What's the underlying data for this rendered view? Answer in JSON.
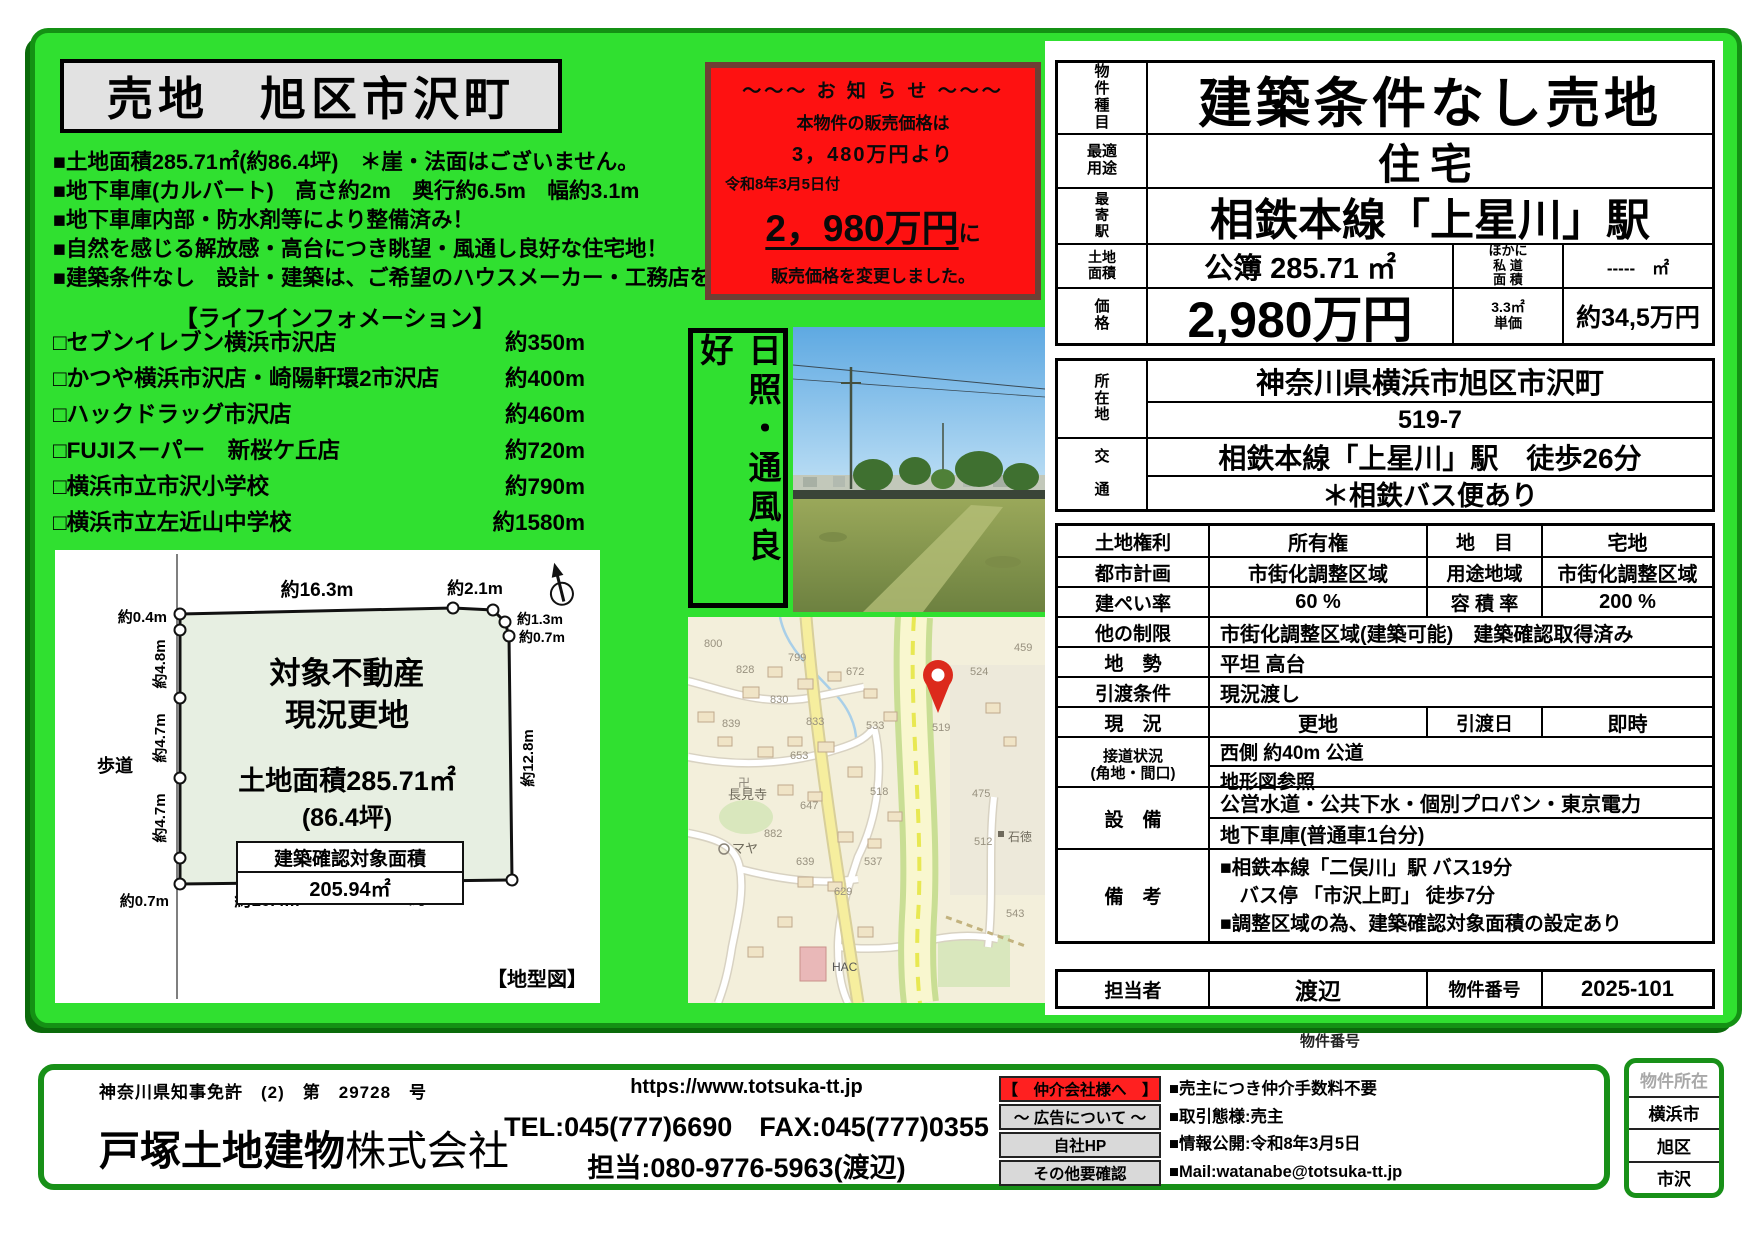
{
  "flyer": {
    "title": "売地　旭区市沢町",
    "bullets": [
      "■土地面積285.71㎡(約86.4坪)　＊崖・法面はございません。",
      "■地下車庫(カルバート)　高さ約2m　奥行約6.5m　幅約3.1m",
      "■地下車庫内部・防水剤等により整備済み！",
      "■自然を感じる解放感・高台につき眺望・風通し良好な住宅地！",
      "■建築条件なし　設計・建築は、ご希望のハウスメーカー・工務店を！"
    ],
    "life_title": "【ライフインフォメーション】",
    "life_items": [
      {
        "name": "□セブンイレブン横浜市沢店",
        "dist": "約350m"
      },
      {
        "name": "□かつや横浜市沢店・崎陽軒環2市沢店",
        "dist": "約400m"
      },
      {
        "name": "□ハックドラッグ市沢店",
        "dist": "約460m"
      },
      {
        "name": "□FUJIスーパー　新桜ケ丘店",
        "dist": "約720m"
      },
      {
        "name": "□横浜市立市沢小学校",
        "dist": "約790m"
      },
      {
        "name": "□横浜市立左近山中学校",
        "dist": "約1580m"
      }
    ]
  },
  "notice": {
    "header": "～～～ お 知 ら せ ～～～",
    "line1": "本物件の販売価格は",
    "line2": "3，480万円より",
    "date": "令和8年3月5日付",
    "new_price": "2，980万円",
    "new_price_suffix": "に",
    "line3": "販売価格を変更しました。"
  },
  "badge": {
    "text": "日照・通風良好"
  },
  "diagram": {
    "top1": "約16.3m",
    "top2": "約2.1m",
    "left1": "約0.4m",
    "left2": "約4.8m",
    "left3": "約4.7m",
    "left4": "約4.7m",
    "left5": "約0.7m",
    "right1": "約1.3m",
    "right2": "約0.7m",
    "right3": "約12.8m",
    "bottom1": "約10.4m",
    "bottom2": "約8.1m",
    "sidewalk": "歩道",
    "c1": "対象不動産",
    "c2": "現況更地",
    "c3": "土地面積285.71㎡",
    "c4": "(86.4坪)",
    "box_title": "建築確認対象面積",
    "box_value": "205.94㎡",
    "caption": "【地型図】"
  },
  "map": {
    "pin_label": "519",
    "temple_mark": "卍",
    "labels": [
      "800",
      "828",
      "799",
      "672",
      "830",
      "833",
      "839",
      "533",
      "653",
      "518",
      "647",
      "882",
      "639",
      "537",
      "629",
      "524",
      "459",
      "512",
      "543",
      "475",
      "石徳",
      "長見寺",
      "マヤ",
      "HAC"
    ]
  },
  "table": {
    "r1_label": "物\n件\n種\n目",
    "r1_value": "建築条件なし売地",
    "r2_label": "最適\n用途",
    "r2_value": "住宅",
    "r3_label": "最\n寄\n駅",
    "r3_value": "相鉄本線「上星川」駅",
    "r4_label": "土地\n面積",
    "r4_value": "公簿 285.71 ㎡",
    "r4_sublabel": "ほかに\n私 道\n面 積",
    "r4_subvalue": "-----　㎡",
    "r5_label": "価\n格",
    "r5_value": "2,980万円",
    "r5_sublabel": "3.3㎡\n単価",
    "r5_subvalue": "約34,5万円",
    "loc_label": "所\n在\n地",
    "loc1": "神奈川県横浜市旭区市沢町",
    "loc2": "519-7",
    "acc_label": "交\n\n通",
    "acc1": "相鉄本線「上星川」駅　徒歩26分",
    "acc2": "＊相鉄バス便あり",
    "rows3": [
      {
        "l": "土地権利",
        "v": "所有権",
        "l2": "地　目",
        "v2": "宅地"
      },
      {
        "l": "都市計画",
        "v": "市街化調整区域",
        "l2": "用途地域",
        "v2": "市街化調整区域"
      },
      {
        "l": "建ぺい率",
        "v": "60 %",
        "l2": "容 積 率",
        "v2": "200 %"
      },
      {
        "l": "他の制限",
        "v": "市街化調整区域(建築可能)　建築確認取得済み"
      },
      {
        "l": "地　勢",
        "v": "平坦 高台"
      },
      {
        "l": "引渡条件",
        "v": "現況渡し"
      },
      {
        "l": "現　況",
        "v": "更地",
        "l2": "引渡日",
        "v2": "即時"
      },
      {
        "l": "接道状況\n(角地・間口)",
        "v": "西側 約40m 公道",
        "v2": "地形図参照"
      },
      {
        "l": "設　備",
        "v": "公営水道・公共下水・個別プロパン・東京電力",
        "v2": "地下車庫(普通車1台分)"
      },
      {
        "l": "備　考",
        "v": "■相鉄本線「二俣川」駅 バス19分",
        "v2": "　バス停 「市沢上町」 徒歩7分",
        "v3": "■調整区域の為、建築確認対象面積の設定あり"
      }
    ],
    "staff_label": "担当者",
    "staff": "渡辺",
    "num_label": "物件番号",
    "num": "2025-101"
  },
  "footer": {
    "license": "神奈川県知事免許　(2)　第　29728　号",
    "company": "戸塚土地建物",
    "company_suffix": "株式会社",
    "url": "https://www.totsuka-tt.jp",
    "telfax": "TEL:045(777)6690　FAX:045(777)0355",
    "mobile": "担当:080-9776-5963(渡辺)",
    "tag1": "【　仲介会社様へ　】",
    "tag2": "～ 広告について ～",
    "tag3": "自社HP",
    "tag4": "その他要確認",
    "note1": "■売主につき仲介手数料不要",
    "note2": "■取引態様:売主",
    "note3": "■情報公開:令和8年3月5日",
    "note4": "■Mail:watanabe@totsuka-tt.jp",
    "prop_num_label": "物件番号",
    "loc_head": "物件所在",
    "loc_rows": [
      "横浜市",
      "旭区",
      "市沢"
    ]
  },
  "colors": {
    "green": "#30e030",
    "frame": "#149114",
    "notice_red": "#fe1111"
  }
}
